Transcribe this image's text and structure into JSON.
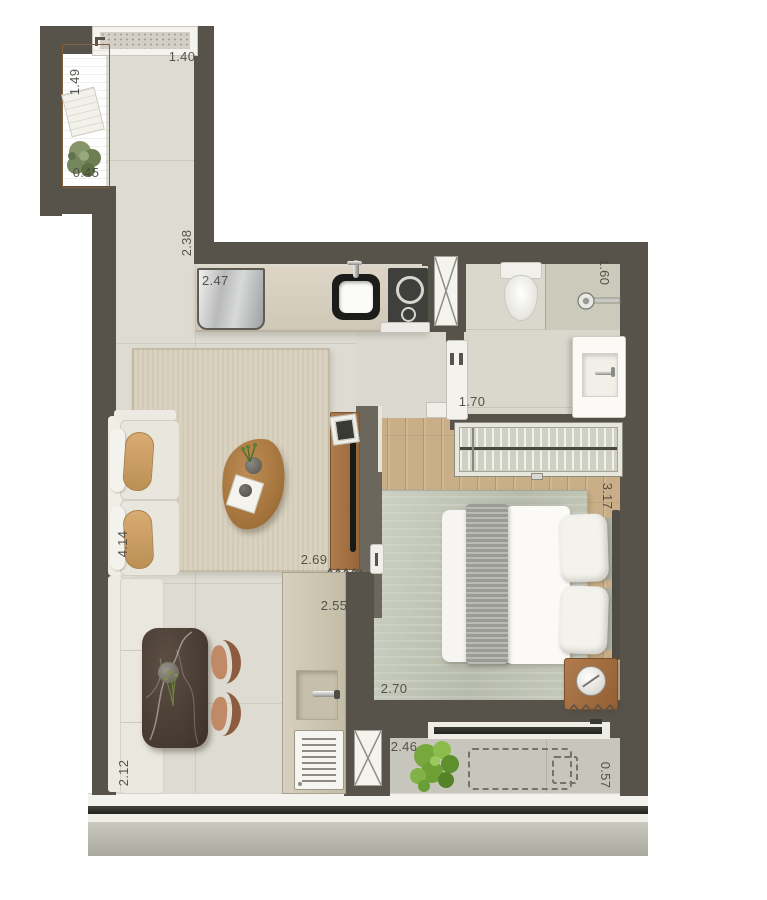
{
  "measurements": {
    "entry_bench_length": "1.49",
    "entry_bench_depth": "0.45",
    "entry_width": "1.40",
    "entry_length": "2.38",
    "kitchen_counter_length": "2.47",
    "bathroom_length": "1.60",
    "bedroom_opening_width": "1.70",
    "bedroom_length": "3.17",
    "living_width": "2.69",
    "hall_length": "2.55",
    "bedroom_width": "2.70",
    "dining_length": "2.12",
    "living_length": "4.14",
    "service_balcony_width": "2.46",
    "service_balcony_depth": "0.57"
  },
  "palette": {
    "wall": "#57534b",
    "floor_tile": "#dedcd2",
    "wood_floor": "#c9ae88",
    "furniture_wood": "#a87748",
    "plant_green": "#76a83e"
  }
}
